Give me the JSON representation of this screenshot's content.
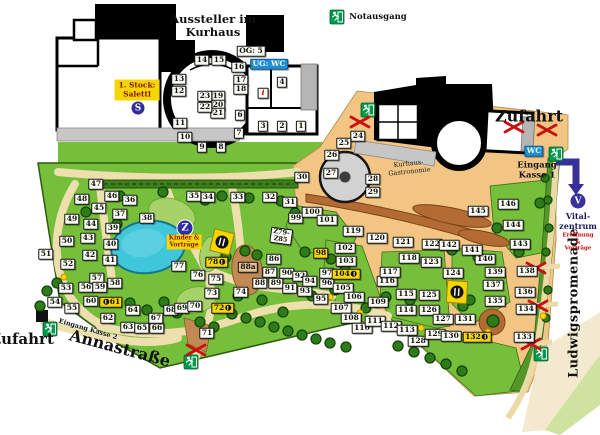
{
  "legend": {
    "notausgang_label": "Notausgang"
  },
  "kurhaus_building": {
    "title": "Aussteller im\nKurhaus",
    "og_label": "OG: 5",
    "ug_label": "UG: WC",
    "salettl_label": "1. Stock:\nSalettl",
    "stairs_badge": "S"
  },
  "gastronomie_complex": {
    "zufahrt_label": "Zufahrt",
    "wc_label": "WC",
    "entrance1_label": "Eingang\nKasse 1",
    "gastronomie_label": "Kurhaus-\nGastronomie"
  },
  "park": {
    "zufahrt_left_label": "Zufahrt",
    "annastrasse_label": "Annastraße",
    "entrance2_label": "Eingang Kasse 2",
    "promenade_label": "Ludwigspromenade",
    "kinder_badge": "Z",
    "kinder_label": "Kinder &\nVorträge",
    "z_block_label": "Z79-\nZ85",
    "vital": {
      "badge": "V",
      "name": "Vital-\nzentrum",
      "sub": "Eröffnung &\nVorträge"
    }
  },
  "colors": {
    "grass": "#76bf3b",
    "sand": "#f2c583",
    "path": "#eedfae",
    "water": "#3fc6da",
    "accent_yellow": "#f6d500",
    "exit_green": "#009a4c",
    "closure_red": "#c81010",
    "wc_blue": "#1e8fd5",
    "arrow_purple": "#38309b"
  },
  "markers": [
    {
      "n": "1",
      "x": 301,
      "y": 126
    },
    {
      "n": "2",
      "x": 282,
      "y": 126
    },
    {
      "n": "3",
      "x": 263,
      "y": 126
    },
    {
      "n": "4",
      "x": 282,
      "y": 82
    },
    {
      "n": "6",
      "x": 240,
      "y": 115
    },
    {
      "n": "7",
      "x": 239,
      "y": 133
    },
    {
      "n": "8",
      "x": 221,
      "y": 147
    },
    {
      "n": "9",
      "x": 202,
      "y": 147
    },
    {
      "n": "10",
      "x": 185,
      "y": 137
    },
    {
      "n": "11",
      "x": 180,
      "y": 123
    },
    {
      "n": "12",
      "x": 179,
      "y": 91
    },
    {
      "n": "13",
      "x": 179,
      "y": 79
    },
    {
      "n": "14",
      "x": 202,
      "y": 60
    },
    {
      "n": "15",
      "x": 219,
      "y": 60
    },
    {
      "n": "16",
      "x": 239,
      "y": 67
    },
    {
      "n": "17",
      "x": 241,
      "y": 80
    },
    {
      "n": "18",
      "x": 241,
      "y": 89
    },
    {
      "n": "19",
      "x": 218,
      "y": 96
    },
    {
      "n": "20",
      "x": 218,
      "y": 105
    },
    {
      "n": "21",
      "x": 218,
      "y": 113
    },
    {
      "n": "22",
      "x": 205,
      "y": 107
    },
    {
      "n": "23",
      "x": 205,
      "y": 96
    },
    {
      "n": "i",
      "x": 263,
      "y": 93,
      "s": "i"
    },
    {
      "n": "24",
      "x": 358,
      "y": 136
    },
    {
      "n": "25",
      "x": 344,
      "y": 143
    },
    {
      "n": "26",
      "x": 332,
      "y": 155
    },
    {
      "n": "27",
      "x": 331,
      "y": 173
    },
    {
      "n": "28",
      "x": 373,
      "y": 179
    },
    {
      "n": "29",
      "x": 373,
      "y": 192
    },
    {
      "n": "30",
      "x": 302,
      "y": 177
    },
    {
      "n": "31",
      "x": 290,
      "y": 202
    },
    {
      "n": "32",
      "x": 270,
      "y": 197
    },
    {
      "n": "33",
      "x": 238,
      "y": 197
    },
    {
      "n": "34",
      "x": 208,
      "y": 197
    },
    {
      "n": "35",
      "x": 194,
      "y": 196
    },
    {
      "n": "36",
      "x": 130,
      "y": 200
    },
    {
      "n": "37",
      "x": 120,
      "y": 214
    },
    {
      "n": "38",
      "x": 147,
      "y": 218
    },
    {
      "n": "39",
      "x": 113,
      "y": 228
    },
    {
      "n": "40",
      "x": 111,
      "y": 244
    },
    {
      "n": "41",
      "x": 110,
      "y": 260
    },
    {
      "n": "42",
      "x": 90,
      "y": 255
    },
    {
      "n": "43",
      "x": 88,
      "y": 238
    },
    {
      "n": "44",
      "x": 91,
      "y": 224
    },
    {
      "n": "45",
      "x": 99,
      "y": 208
    },
    {
      "n": "46",
      "x": 112,
      "y": 196
    },
    {
      "n": "47",
      "x": 96,
      "y": 184
    },
    {
      "n": "48",
      "x": 82,
      "y": 199
    },
    {
      "n": "49",
      "x": 72,
      "y": 219
    },
    {
      "n": "50",
      "x": 67,
      "y": 241
    },
    {
      "n": "51",
      "x": 46,
      "y": 254
    },
    {
      "n": "52",
      "x": 68,
      "y": 264
    },
    {
      "n": "53",
      "x": 66,
      "y": 288
    },
    {
      "n": "54",
      "x": 55,
      "y": 302
    },
    {
      "n": "55",
      "x": 72,
      "y": 308
    },
    {
      "n": "56",
      "x": 86,
      "y": 287
    },
    {
      "n": "57",
      "x": 97,
      "y": 278
    },
    {
      "n": "58",
      "x": 115,
      "y": 283
    },
    {
      "n": "59",
      "x": 100,
      "y": 287
    },
    {
      "n": "60",
      "x": 91,
      "y": 301
    },
    {
      "n": "61",
      "x": 111,
      "y": 302,
      "s": "y",
      "d": "pre"
    },
    {
      "n": "62",
      "x": 108,
      "y": 318
    },
    {
      "n": "63",
      "x": 128,
      "y": 327
    },
    {
      "n": "64",
      "x": 133,
      "y": 310
    },
    {
      "n": "65",
      "x": 142,
      "y": 328
    },
    {
      "n": "66",
      "x": 157,
      "y": 328
    },
    {
      "n": "67",
      "x": 156,
      "y": 318
    },
    {
      "n": "68",
      "x": 171,
      "y": 310
    },
    {
      "n": "69",
      "x": 182,
      "y": 308
    },
    {
      "n": "70",
      "x": 195,
      "y": 306
    },
    {
      "n": "71",
      "x": 207,
      "y": 333
    },
    {
      "n": "72",
      "x": 223,
      "y": 308,
      "s": "y",
      "d": "post"
    },
    {
      "n": "73",
      "x": 212,
      "y": 293
    },
    {
      "n": "74",
      "x": 241,
      "y": 292
    },
    {
      "n": "75",
      "x": 216,
      "y": 279
    },
    {
      "n": "76",
      "x": 198,
      "y": 275
    },
    {
      "n": "77",
      "x": 179,
      "y": 266
    },
    {
      "n": "78",
      "x": 217,
      "y": 262,
      "s": "y",
      "d": "post"
    },
    {
      "n": "86",
      "x": 274,
      "y": 259
    },
    {
      "n": "87",
      "x": 270,
      "y": 272
    },
    {
      "n": "88",
      "x": 260,
      "y": 283
    },
    {
      "n": "88a",
      "x": 248,
      "y": 267,
      "s": "t"
    },
    {
      "n": "89",
      "x": 276,
      "y": 283
    },
    {
      "n": "90",
      "x": 287,
      "y": 273
    },
    {
      "n": "91",
      "x": 290,
      "y": 288
    },
    {
      "n": "92",
      "x": 300,
      "y": 276
    },
    {
      "n": "93",
      "x": 305,
      "y": 291
    },
    {
      "n": "94",
      "x": 310,
      "y": 281
    },
    {
      "n": "95",
      "x": 321,
      "y": 299
    },
    {
      "n": "96",
      "x": 327,
      "y": 283
    },
    {
      "n": "97",
      "x": 327,
      "y": 273
    },
    {
      "n": "98",
      "x": 321,
      "y": 253,
      "s": "y"
    },
    {
      "n": "99",
      "x": 296,
      "y": 218
    },
    {
      "n": "100",
      "x": 312,
      "y": 212
    },
    {
      "n": "101",
      "x": 327,
      "y": 220
    },
    {
      "n": "102",
      "x": 345,
      "y": 248
    },
    {
      "n": "103",
      "x": 346,
      "y": 261
    },
    {
      "n": "104",
      "x": 346,
      "y": 274,
      "s": "y",
      "d": "post"
    },
    {
      "n": "105",
      "x": 343,
      "y": 288
    },
    {
      "n": "106",
      "x": 354,
      "y": 297
    },
    {
      "n": "107",
      "x": 341,
      "y": 308
    },
    {
      "n": "108",
      "x": 351,
      "y": 318
    },
    {
      "n": "109",
      "x": 378,
      "y": 302
    },
    {
      "n": "110",
      "x": 362,
      "y": 328
    },
    {
      "n": "111",
      "x": 375,
      "y": 321
    },
    {
      "n": "112",
      "x": 391,
      "y": 326
    },
    {
      "n": "113",
      "x": 407,
      "y": 330
    },
    {
      "n": "114",
      "x": 406,
      "y": 310
    },
    {
      "n": "115",
      "x": 406,
      "y": 294
    },
    {
      "n": "116",
      "x": 387,
      "y": 281
    },
    {
      "n": "117",
      "x": 390,
      "y": 272
    },
    {
      "n": "118",
      "x": 409,
      "y": 258
    },
    {
      "n": "119",
      "x": 353,
      "y": 231
    },
    {
      "n": "120",
      "x": 377,
      "y": 238
    },
    {
      "n": "121",
      "x": 403,
      "y": 242
    },
    {
      "n": "122",
      "x": 432,
      "y": 244
    },
    {
      "n": "123",
      "x": 431,
      "y": 262
    },
    {
      "n": "124",
      "x": 453,
      "y": 273
    },
    {
      "n": "125",
      "x": 429,
      "y": 295
    },
    {
      "n": "126",
      "x": 429,
      "y": 310
    },
    {
      "n": "127",
      "x": 443,
      "y": 319
    },
    {
      "n": "128",
      "x": 418,
      "y": 341
    },
    {
      "n": "129",
      "x": 435,
      "y": 334
    },
    {
      "n": "130",
      "x": 451,
      "y": 336
    },
    {
      "n": "131",
      "x": 465,
      "y": 319
    },
    {
      "n": "132",
      "x": 477,
      "y": 337,
      "s": "y",
      "d": "post"
    },
    {
      "n": "133",
      "x": 524,
      "y": 337
    },
    {
      "n": "134",
      "x": 526,
      "y": 309
    },
    {
      "n": "135",
      "x": 495,
      "y": 301
    },
    {
      "n": "136",
      "x": 525,
      "y": 292
    },
    {
      "n": "137",
      "x": 493,
      "y": 285
    },
    {
      "n": "138",
      "x": 527,
      "y": 271
    },
    {
      "n": "139",
      "x": 495,
      "y": 272
    },
    {
      "n": "140",
      "x": 485,
      "y": 259
    },
    {
      "n": "141",
      "x": 472,
      "y": 250
    },
    {
      "n": "142",
      "x": 449,
      "y": 245
    },
    {
      "n": "143",
      "x": 520,
      "y": 244
    },
    {
      "n": "144",
      "x": 513,
      "y": 225
    },
    {
      "n": "145",
      "x": 478,
      "y": 211
    },
    {
      "n": "146",
      "x": 508,
      "y": 204
    }
  ],
  "map_features": {
    "trees": [
      [
        47,
        291
      ],
      [
        40,
        306
      ],
      [
        57,
        283
      ],
      [
        86,
        212
      ],
      [
        117,
        224
      ],
      [
        130,
        303
      ],
      [
        147,
        310
      ],
      [
        164,
        302
      ],
      [
        177,
        313
      ],
      [
        200,
        322
      ],
      [
        214,
        327
      ],
      [
        120,
        196
      ],
      [
        163,
        192
      ],
      [
        205,
        200
      ],
      [
        222,
        196
      ],
      [
        249,
        198
      ],
      [
        281,
        201
      ],
      [
        232,
        314
      ],
      [
        246,
        318
      ],
      [
        260,
        322
      ],
      [
        274,
        327
      ],
      [
        288,
        331
      ],
      [
        302,
        335
      ],
      [
        316,
        339
      ],
      [
        262,
        300
      ],
      [
        238,
        296
      ],
      [
        283,
        312
      ],
      [
        226,
        257
      ],
      [
        245,
        251
      ],
      [
        257,
        255
      ],
      [
        295,
        213
      ],
      [
        305,
        252
      ],
      [
        331,
        259
      ],
      [
        345,
        266
      ],
      [
        452,
        250
      ],
      [
        497,
        228
      ],
      [
        519,
        252
      ],
      [
        540,
        203
      ],
      [
        463,
        306
      ],
      [
        493,
        321,
        6
      ],
      [
        386,
        297
      ],
      [
        366,
        308
      ],
      [
        410,
        300
      ],
      [
        335,
        290
      ],
      [
        312,
        296
      ],
      [
        398,
        346
      ],
      [
        414,
        352
      ],
      [
        430,
        358
      ],
      [
        446,
        364
      ],
      [
        462,
        371
      ],
      [
        545,
        178,
        4
      ],
      [
        548,
        200,
        4
      ],
      [
        549,
        228,
        4
      ],
      [
        546,
        252,
        4
      ],
      [
        548,
        290,
        4
      ],
      [
        546,
        318,
        4
      ],
      [
        478,
        257
      ],
      [
        470,
        300
      ],
      [
        330,
        343
      ],
      [
        346,
        347
      ]
    ],
    "lamps": [
      [
        64,
        277
      ],
      [
        330,
        297
      ],
      [
        360,
        313
      ],
      [
        421,
        328
      ],
      [
        488,
        332
      ],
      [
        543,
        316
      ]
    ],
    "closed_paths": [
      [
        360,
        122
      ],
      [
        514,
        127
      ],
      [
        547,
        130
      ],
      [
        536,
        268
      ],
      [
        538,
        306
      ],
      [
        531,
        344
      ],
      [
        196,
        350
      ]
    ],
    "exits": [
      [
        337,
        17
      ],
      [
        368,
        110
      ],
      [
        556,
        154
      ],
      [
        541,
        354
      ],
      [
        191,
        362
      ],
      [
        50,
        329
      ]
    ],
    "gastro_signs": [
      [
        222,
        242,
        14
      ],
      [
        457,
        292,
        4
      ]
    ]
  }
}
